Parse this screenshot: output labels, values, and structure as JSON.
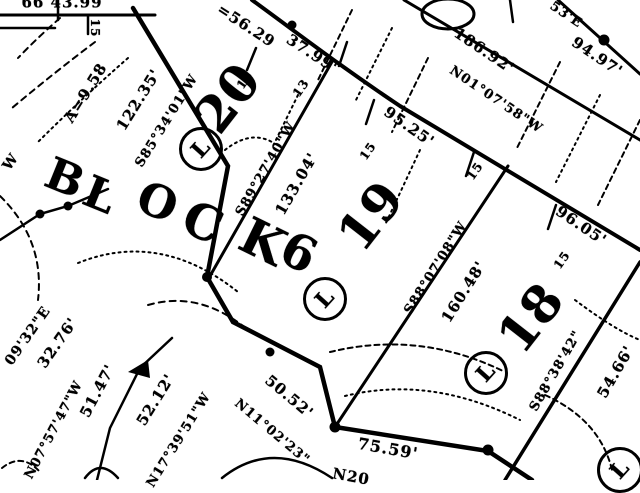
{
  "title": "Scanned plat map detail - Block 6, Lots 18, 19, 20",
  "map": {
    "lot_marker_letter": "L",
    "block_letters": [
      {
        "text": "B",
        "x": 65,
        "y": 179,
        "rot": 22,
        "size": 44
      },
      {
        "text": "L",
        "x": 100,
        "y": 196,
        "rot": 22,
        "size": 44
      },
      {
        "text": "O",
        "x": 158,
        "y": 202,
        "rot": 22,
        "size": 45
      },
      {
        "text": "C",
        "x": 203,
        "y": 223,
        "rot": 24,
        "size": 48
      },
      {
        "text": "K",
        "x": 263,
        "y": 242,
        "rot": 26,
        "size": 50
      },
      {
        "text": "6",
        "x": 299,
        "y": 253,
        "rot": 26,
        "size": 48
      }
    ],
    "lot_numbers": [
      {
        "text": "20",
        "x": 228,
        "y": 98,
        "rot": -52,
        "size": 50
      },
      {
        "text": "19",
        "x": 371,
        "y": 216,
        "rot": -52,
        "size": 50
      },
      {
        "text": "18",
        "x": 531,
        "y": 318,
        "rot": -52,
        "size": 50
      }
    ],
    "lot_markers": [
      {
        "letter": "L",
        "x": 198,
        "y": 146,
        "r": 19
      },
      {
        "letter": "L",
        "x": 322,
        "y": 296,
        "r": 19
      },
      {
        "letter": "L",
        "x": 483,
        "y": 370,
        "r": 19
      },
      {
        "letter": "L",
        "x": 617,
        "y": 467,
        "r": 20
      }
    ],
    "labels": [
      {
        "text": "66 43.99",
        "x": 62,
        "y": 3,
        "rot": 0,
        "size": 15
      },
      {
        "text": "15",
        "x": 95,
        "y": 28,
        "rot": 90,
        "size": 12
      },
      {
        "text": "A=9.58",
        "x": 86,
        "y": 93,
        "rot": -58,
        "size": 15
      },
      {
        "text": "122.35'",
        "x": 139,
        "y": 100,
        "rot": -58,
        "size": 15
      },
      {
        "text": "S85°34'01\"W",
        "x": 167,
        "y": 121,
        "rot": -58,
        "size": 13
      },
      {
        "text": "=56.29",
        "x": 246,
        "y": 26,
        "rot": 33,
        "size": 15
      },
      {
        "text": "37.99'",
        "x": 312,
        "y": 54,
        "rot": 33,
        "size": 15
      },
      {
        "text": "15",
        "x": 245,
        "y": 80,
        "rot": -55,
        "size": 12
      },
      {
        "text": "13",
        "x": 301,
        "y": 88,
        "rot": -55,
        "size": 12
      },
      {
        "text": "95.25'",
        "x": 409,
        "y": 127,
        "rot": 35,
        "size": 15
      },
      {
        "text": "15",
        "x": 368,
        "y": 151,
        "rot": -55,
        "size": 12
      },
      {
        "text": "186.92'",
        "x": 484,
        "y": 51,
        "rot": 34,
        "size": 15
      },
      {
        "text": "N01°07'58\"W",
        "x": 496,
        "y": 100,
        "rot": 34,
        "size": 13
      },
      {
        "text": "53'E",
        "x": 566,
        "y": 15,
        "rot": 34,
        "size": 13
      },
      {
        "text": "94.97'",
        "x": 597,
        "y": 57,
        "rot": 34,
        "size": 15
      },
      {
        "text": "S89°27'40\"W",
        "x": 266,
        "y": 169,
        "rot": -60,
        "size": 13
      },
      {
        "text": "133.04'",
        "x": 297,
        "y": 184,
        "rot": -60,
        "size": 15
      },
      {
        "text": "S88°07'08\"W",
        "x": 436,
        "y": 268,
        "rot": -58,
        "size": 13
      },
      {
        "text": "160.48'",
        "x": 464,
        "y": 292,
        "rot": -58,
        "size": 15
      },
      {
        "text": "15",
        "x": 475,
        "y": 171,
        "rot": -55,
        "size": 12
      },
      {
        "text": "96.05'",
        "x": 581,
        "y": 226,
        "rot": 34,
        "size": 15
      },
      {
        "text": "15",
        "x": 562,
        "y": 260,
        "rot": -55,
        "size": 12
      },
      {
        "text": "S88°38'42\"",
        "x": 556,
        "y": 371,
        "rot": -60,
        "size": 13
      },
      {
        "text": "54.66'",
        "x": 616,
        "y": 372,
        "rot": -60,
        "size": 15
      },
      {
        "text": "W",
        "x": 11,
        "y": 162,
        "rot": -55,
        "size": 14
      },
      {
        "text": "09'32\"E",
        "x": 28,
        "y": 336,
        "rot": -55,
        "size": 14
      },
      {
        "text": "32.76'",
        "x": 58,
        "y": 343,
        "rot": -55,
        "size": 15
      },
      {
        "text": "N07°57'47\"W",
        "x": 54,
        "y": 430,
        "rot": -62,
        "size": 13
      },
      {
        "text": "51.47'",
        "x": 98,
        "y": 391,
        "rot": -62,
        "size": 15
      },
      {
        "text": "52.12'",
        "x": 156,
        "y": 400,
        "rot": -58,
        "size": 15
      },
      {
        "text": "N17°39'51\"W",
        "x": 179,
        "y": 440,
        "rot": -58,
        "size": 13
      },
      {
        "text": "50.52'",
        "x": 289,
        "y": 397,
        "rot": 40,
        "size": 15
      },
      {
        "text": "N11°02'23\"",
        "x": 272,
        "y": 432,
        "rot": 40,
        "size": 13
      },
      {
        "text": "75.59'",
        "x": 388,
        "y": 449,
        "rot": 10,
        "size": 16
      },
      {
        "text": "N20",
        "x": 351,
        "y": 477,
        "rot": 10,
        "size": 15
      }
    ]
  }
}
